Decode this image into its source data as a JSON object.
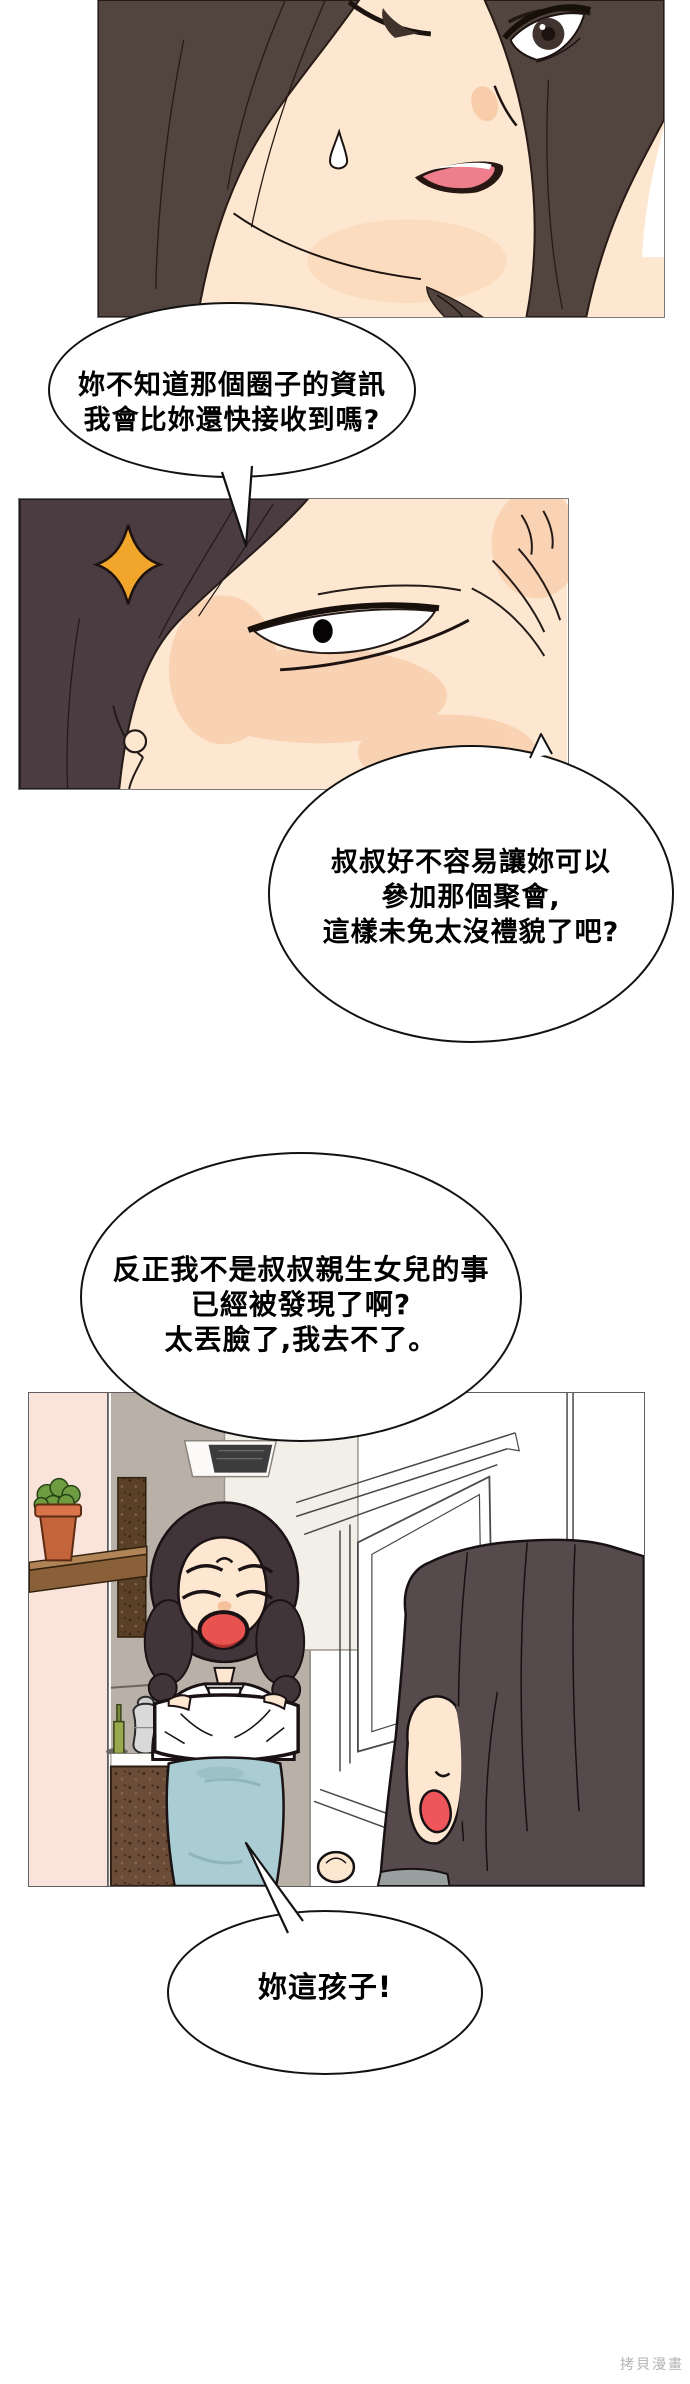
{
  "page": {
    "width": 690,
    "height": 2384,
    "background": "#ffffff",
    "watermark": "拷貝漫畫"
  },
  "bubbles": {
    "bubble1": {
      "lines": [
        "妳不知道那個圈子的資訊",
        "我會比妳還快接收到嗎?"
      ]
    },
    "bubble2": {
      "lines": [
        "叔叔好不容易讓妳可以",
        "參加那個聚會,",
        "這樣未免太沒禮貌了吧?"
      ]
    },
    "bubble3": {
      "lines": [
        "反正我不是叔叔親生女兒的事",
        "已經被發現了啊?",
        "太丟臉了,我去不了。"
      ]
    },
    "bubble4": {
      "lines": [
        "妳這孩子!"
      ]
    }
  },
  "panels": {
    "panel1": {
      "alt": "close-up of worried woman with long dark hair, sweat drop, open mouth"
    },
    "panel2": {
      "alt": "extreme close-up of narrowed eye with wrinkles, dark hair and orange sparkle"
    },
    "panel3": {
      "alt": "kitchen scene: mother with crossed arms shouting at daughter near white door"
    }
  },
  "colors": {
    "hair_dark": "#52443f",
    "hair_mother": "#413539",
    "hair_daughter": "#564a4c",
    "skin": "#fde7d0",
    "skin_shade": "#f8cfae",
    "sparkle_orange": "#f2a52b",
    "mouth_pink": "#ee7e8c",
    "mother_mouth_red": "#e85350",
    "daughter_mouth_red": "#ee565c",
    "skirt_teal": "#a9cdd2",
    "wall_pink": "#fae3da",
    "wall_taupe": "#b9b0a8",
    "shelf_wood": "#a97d52",
    "cabinet_brown": "#6b4c38",
    "pot_terracotta": "#c4643c",
    "plant_green": "#6f9c41",
    "bubble_border": "#121212",
    "watermark_gray": "#b3b3b3"
  }
}
